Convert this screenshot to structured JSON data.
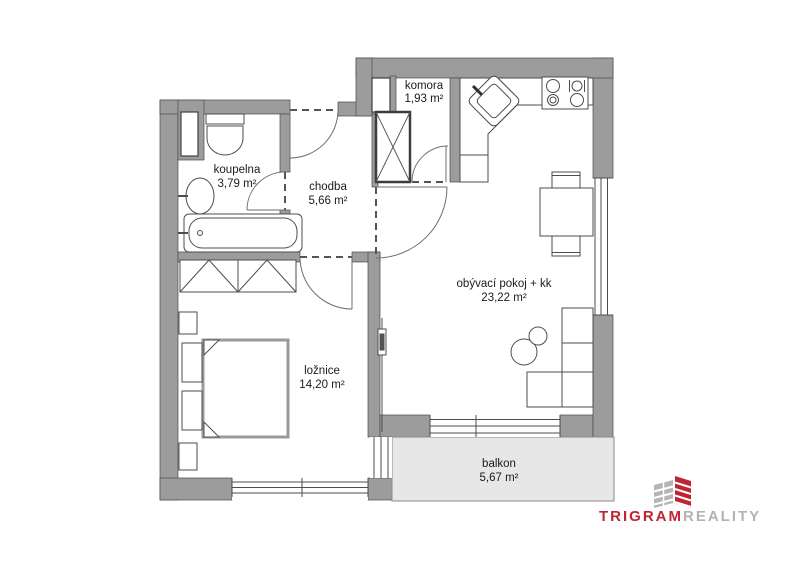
{
  "floorplan": {
    "rooms": [
      {
        "id": "koupelna",
        "name": "koupelna",
        "area": "3,79 m²"
      },
      {
        "id": "chodba",
        "name": "chodba",
        "area": "5,66 m²"
      },
      {
        "id": "komora",
        "name": "komora",
        "area": "1,93 m²"
      },
      {
        "id": "obyvaci",
        "name": "obývací pokoj + kk",
        "area": "23,22 m²"
      },
      {
        "id": "loznice",
        "name": "ložnice",
        "area": "14,20 m²"
      },
      {
        "id": "balkon",
        "name": "balkon",
        "area": "5,67 m²"
      }
    ],
    "colors": {
      "wall": "#9c9c9c",
      "wall_outline": "#4a4a4a",
      "balcony_fill": "#e7e7e7",
      "furniture_line": "#4d4d4d",
      "door_arc": "#6e6e6e"
    }
  },
  "logo": {
    "brand_primary": "TRIGRAM",
    "brand_secondary": "REALITY",
    "primary_color": "#bf2433",
    "secondary_color": "#b3b3b6"
  }
}
